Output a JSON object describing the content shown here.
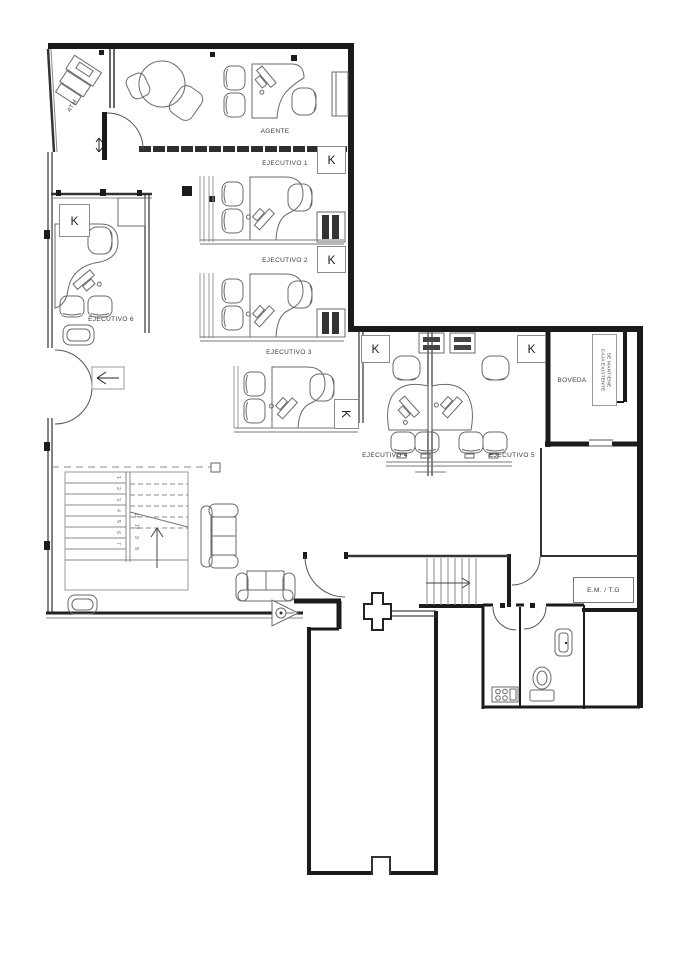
{
  "drawing": {
    "type": "architectural floor plan (bank branch)"
  },
  "rooms": {
    "agente": "AGENTE",
    "ejecutivo_1": "EJECUTIVO 1",
    "ejecutivo_2": "EJECUTIVO 2",
    "ejecutivo_3": "EJECUTIVO 3",
    "ejecutivo_4": "EJECUTIVO 4",
    "ejecutivo_5": "EJECUTIVO 5",
    "ejecutivo_6": "EJECUTIVO 6",
    "boveda": "BOVEDA",
    "atm": "ATM",
    "em_tg": "E.M. / T.G"
  },
  "annotations": {
    "k_marker": "K",
    "vault_note_line1": "SE MANTIENE",
    "vault_note_line2": "CAJA EXISTENTE"
  },
  "stairs": {
    "flight_down": [
      "1",
      "2",
      "3",
      "4",
      "5",
      "6",
      "7"
    ],
    "flight_up": [
      "8",
      "9",
      "10",
      "11"
    ]
  },
  "colors": {
    "wall": "#1b1b1b",
    "furniture_line": "#6a6a6a",
    "background": "#ffffff"
  }
}
